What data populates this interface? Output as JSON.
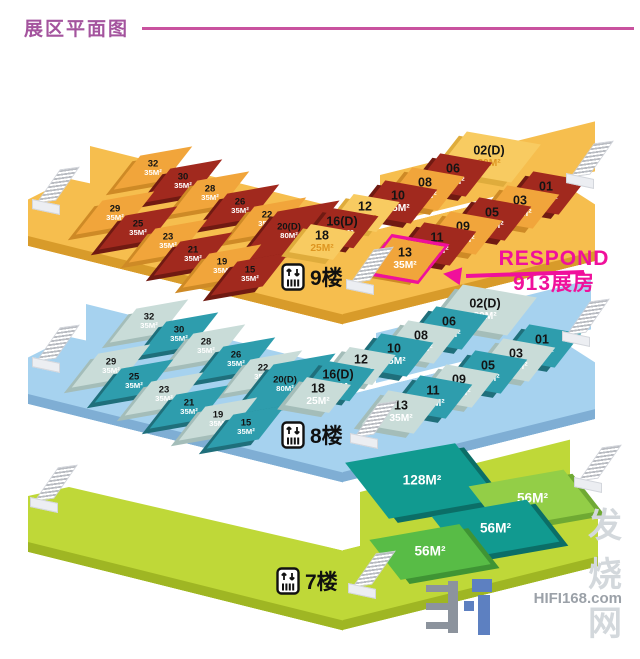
{
  "header": {
    "title": "展区平面图"
  },
  "annotation": {
    "line1": "RESPOND",
    "line2": "913展房",
    "highlight_booth": "13",
    "accent_color": "#f0109b"
  },
  "floors": [
    {
      "id": "f9",
      "label": "9楼",
      "theme": {
        "floor": "#f6be4e",
        "dark_booth": "#a1291e",
        "light_booth": "#f1a53b",
        "pale_booth": "#f8cb61"
      },
      "booths": [
        {
          "no": "32",
          "size": "35M²",
          "tone": "light"
        },
        {
          "no": "30",
          "size": "35M²",
          "tone": "dark"
        },
        {
          "no": "28",
          "size": "35M²",
          "tone": "light"
        },
        {
          "no": "26",
          "size": "35M²",
          "tone": "dark"
        },
        {
          "no": "22",
          "size": "35M²",
          "tone": "light"
        },
        {
          "no": "20(D)",
          "size": "80M²",
          "tone": "dark"
        },
        {
          "no": "29",
          "size": "35M²",
          "tone": "light"
        },
        {
          "no": "25",
          "size": "35M²",
          "tone": "dark"
        },
        {
          "no": "23",
          "size": "35M²",
          "tone": "light"
        },
        {
          "no": "21",
          "size": "35M²",
          "tone": "dark"
        },
        {
          "no": "19",
          "size": "35M²",
          "tone": "light"
        },
        {
          "no": "15",
          "size": "35M²",
          "tone": "dark"
        },
        {
          "no": "02(D)",
          "size": "80M²",
          "tone": "pale"
        },
        {
          "no": "06",
          "size": "35M²",
          "tone": "dark"
        },
        {
          "no": "08",
          "size": "35M²",
          "tone": "light"
        },
        {
          "no": "10",
          "size": "35M²",
          "tone": "dark"
        },
        {
          "no": "12",
          "size": "28M²",
          "tone": "pale"
        },
        {
          "no": "16(D)",
          "size": "20M²",
          "tone": "dark"
        },
        {
          "no": "18",
          "size": "25M²",
          "tone": "pale"
        },
        {
          "no": "01",
          "size": "35M²",
          "tone": "dark"
        },
        {
          "no": "03",
          "size": "35M²",
          "tone": "light"
        },
        {
          "no": "05",
          "size": "35M²",
          "tone": "dark"
        },
        {
          "no": "09",
          "size": "35M²",
          "tone": "light"
        },
        {
          "no": "11",
          "size": "35M²",
          "tone": "dark"
        },
        {
          "no": "13",
          "size": "35M²",
          "tone": "light",
          "highlight": true
        }
      ]
    },
    {
      "id": "f8",
      "label": "8楼",
      "theme": {
        "floor": "#a6d2ef",
        "dark_booth": "#2e9dad",
        "light_booth": "#c9dcd8",
        "pale_booth": "#c9dcd8"
      },
      "booths": [
        {
          "no": "32",
          "size": "35M²",
          "tone": "light"
        },
        {
          "no": "30",
          "size": "35M²",
          "tone": "dark"
        },
        {
          "no": "28",
          "size": "35M²",
          "tone": "light"
        },
        {
          "no": "26",
          "size": "35M²",
          "tone": "dark"
        },
        {
          "no": "22",
          "size": "35M²",
          "tone": "light"
        },
        {
          "no": "20(D)",
          "size": "80M²",
          "tone": "dark"
        },
        {
          "no": "29",
          "size": "35M²",
          "tone": "light"
        },
        {
          "no": "25",
          "size": "35M²",
          "tone": "dark"
        },
        {
          "no": "23",
          "size": "35M²",
          "tone": "light"
        },
        {
          "no": "21",
          "size": "35M²",
          "tone": "dark"
        },
        {
          "no": "19",
          "size": "35M²",
          "tone": "light"
        },
        {
          "no": "15",
          "size": "35M²",
          "tone": "dark"
        },
        {
          "no": "02(D)",
          "size": "80M²",
          "tone": "pale"
        },
        {
          "no": "06",
          "size": "35M²",
          "tone": "dark"
        },
        {
          "no": "08",
          "size": "35M²",
          "tone": "light"
        },
        {
          "no": "10",
          "size": "35M²",
          "tone": "dark"
        },
        {
          "no": "12",
          "size": "28M²",
          "tone": "pale"
        },
        {
          "no": "16(D)",
          "size": "20M",
          "tone": "dark"
        },
        {
          "no": "18",
          "size": "25M²",
          "tone": "pale"
        },
        {
          "no": "01",
          "size": "35M²",
          "tone": "dark"
        },
        {
          "no": "03",
          "size": "35M²",
          "tone": "light"
        },
        {
          "no": "05",
          "size": "35M²",
          "tone": "dark"
        },
        {
          "no": "09",
          "size": "35M²",
          "tone": "light"
        },
        {
          "no": "11",
          "size": "35M²",
          "tone": "dark"
        },
        {
          "no": "13",
          "size": "35M²",
          "tone": "light"
        }
      ]
    },
    {
      "id": "f7",
      "label": "7楼",
      "theme": {
        "floor": "#bfd838",
        "dark_booth": "#119a90",
        "light_booth": "#93ce47",
        "green_booth": "#58bc46"
      },
      "booths": [
        {
          "no": "",
          "size": "128M²",
          "tone": "dark"
        },
        {
          "no": "",
          "size": "56M²",
          "tone": "light"
        },
        {
          "no": "",
          "size": "56M²",
          "tone": "dark"
        },
        {
          "no": "",
          "size": "56M²",
          "tone": "green"
        }
      ]
    }
  ],
  "watermark": {
    "site": "HIFI168.com",
    "name": "发烧网"
  }
}
